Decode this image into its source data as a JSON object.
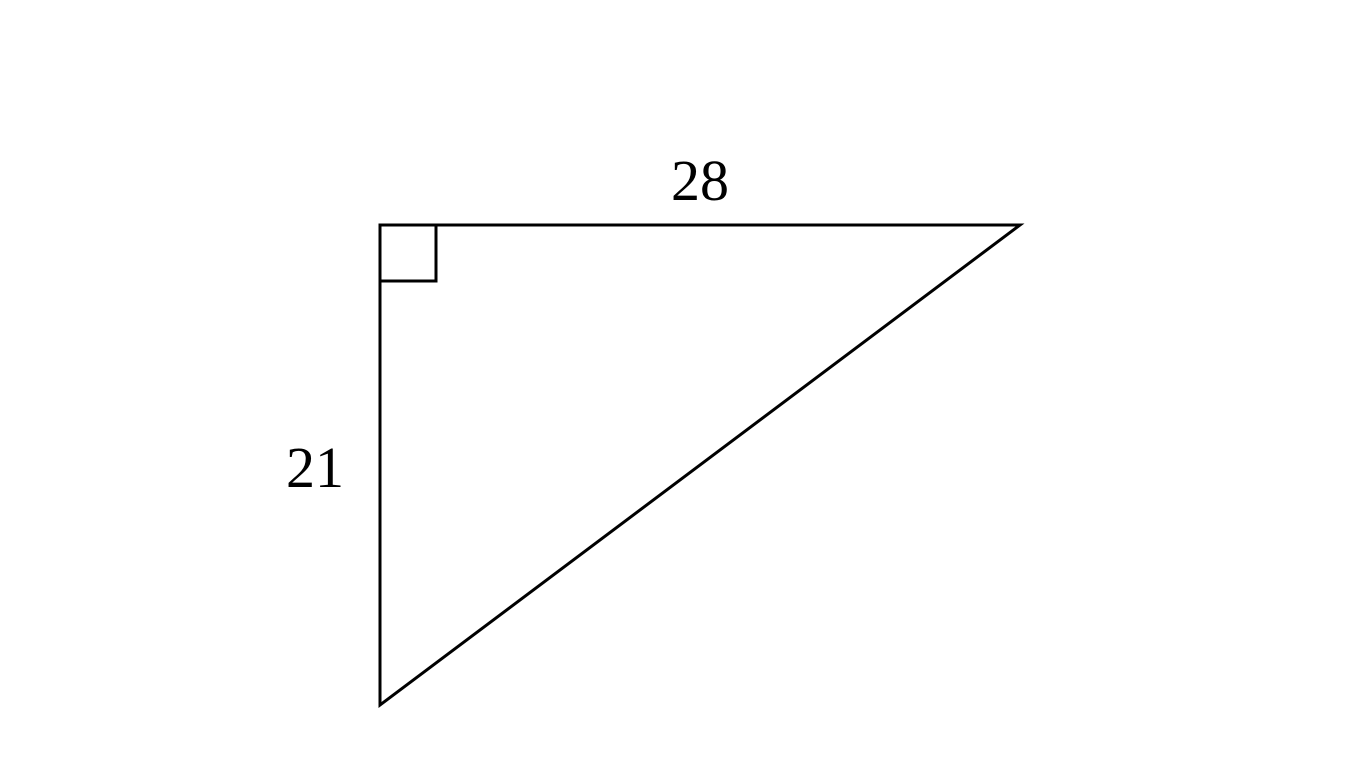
{
  "figure": {
    "type": "right-triangle",
    "background_color": "#ffffff",
    "stroke_color": "#000000",
    "stroke_width": 3,
    "labels": {
      "top_side": "28",
      "left_side": "21"
    },
    "vertices": {
      "right_angle": {
        "x": 380,
        "y": 225
      },
      "top_right": {
        "x": 1020,
        "y": 225
      },
      "bottom": {
        "x": 380,
        "y": 705
      }
    },
    "right_angle_marker_size": 56,
    "label_offsets": {
      "top": {
        "dx": 0,
        "dy": -25
      },
      "left": {
        "dx": -65,
        "dy": 22
      }
    }
  },
  "chart_data": {
    "type": "table",
    "title": "Right triangle with legs 28 (top) and 21 (left)",
    "sides": [
      {
        "position": "top",
        "length": 28
      },
      {
        "position": "left",
        "length": 21
      }
    ],
    "right_angle_at": "top-left vertex"
  }
}
